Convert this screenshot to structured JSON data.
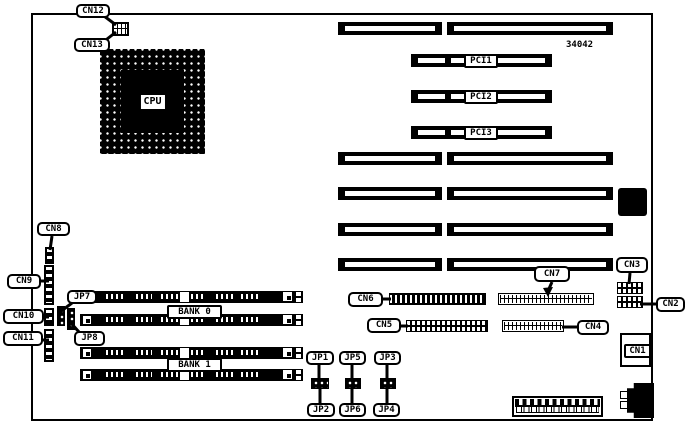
{
  "figure": {
    "part_number": "34042"
  },
  "labels": {
    "cpu": "CPU",
    "bank0": "BANK 0",
    "bank1": "BANK 1",
    "pci1": "PCI1",
    "pci2": "PCI2",
    "pci3": "PCI3",
    "cn1": "CN1",
    "cn2": "CN2",
    "cn3": "CN3",
    "cn4": "CN4",
    "cn5": "CN5",
    "cn6": "CN6",
    "cn7": "CN7",
    "cn8": "CN8",
    "cn9": "CN9",
    "cn10": "CN10",
    "cn11": "CN11",
    "cn12": "CN12",
    "cn13": "CN13",
    "jp1": "JP1",
    "jp2": "JP2",
    "jp3": "JP3",
    "jp4": "JP4",
    "jp5": "JP5",
    "jp6": "JP6",
    "jp7": "JP7",
    "jp8": "JP8"
  }
}
